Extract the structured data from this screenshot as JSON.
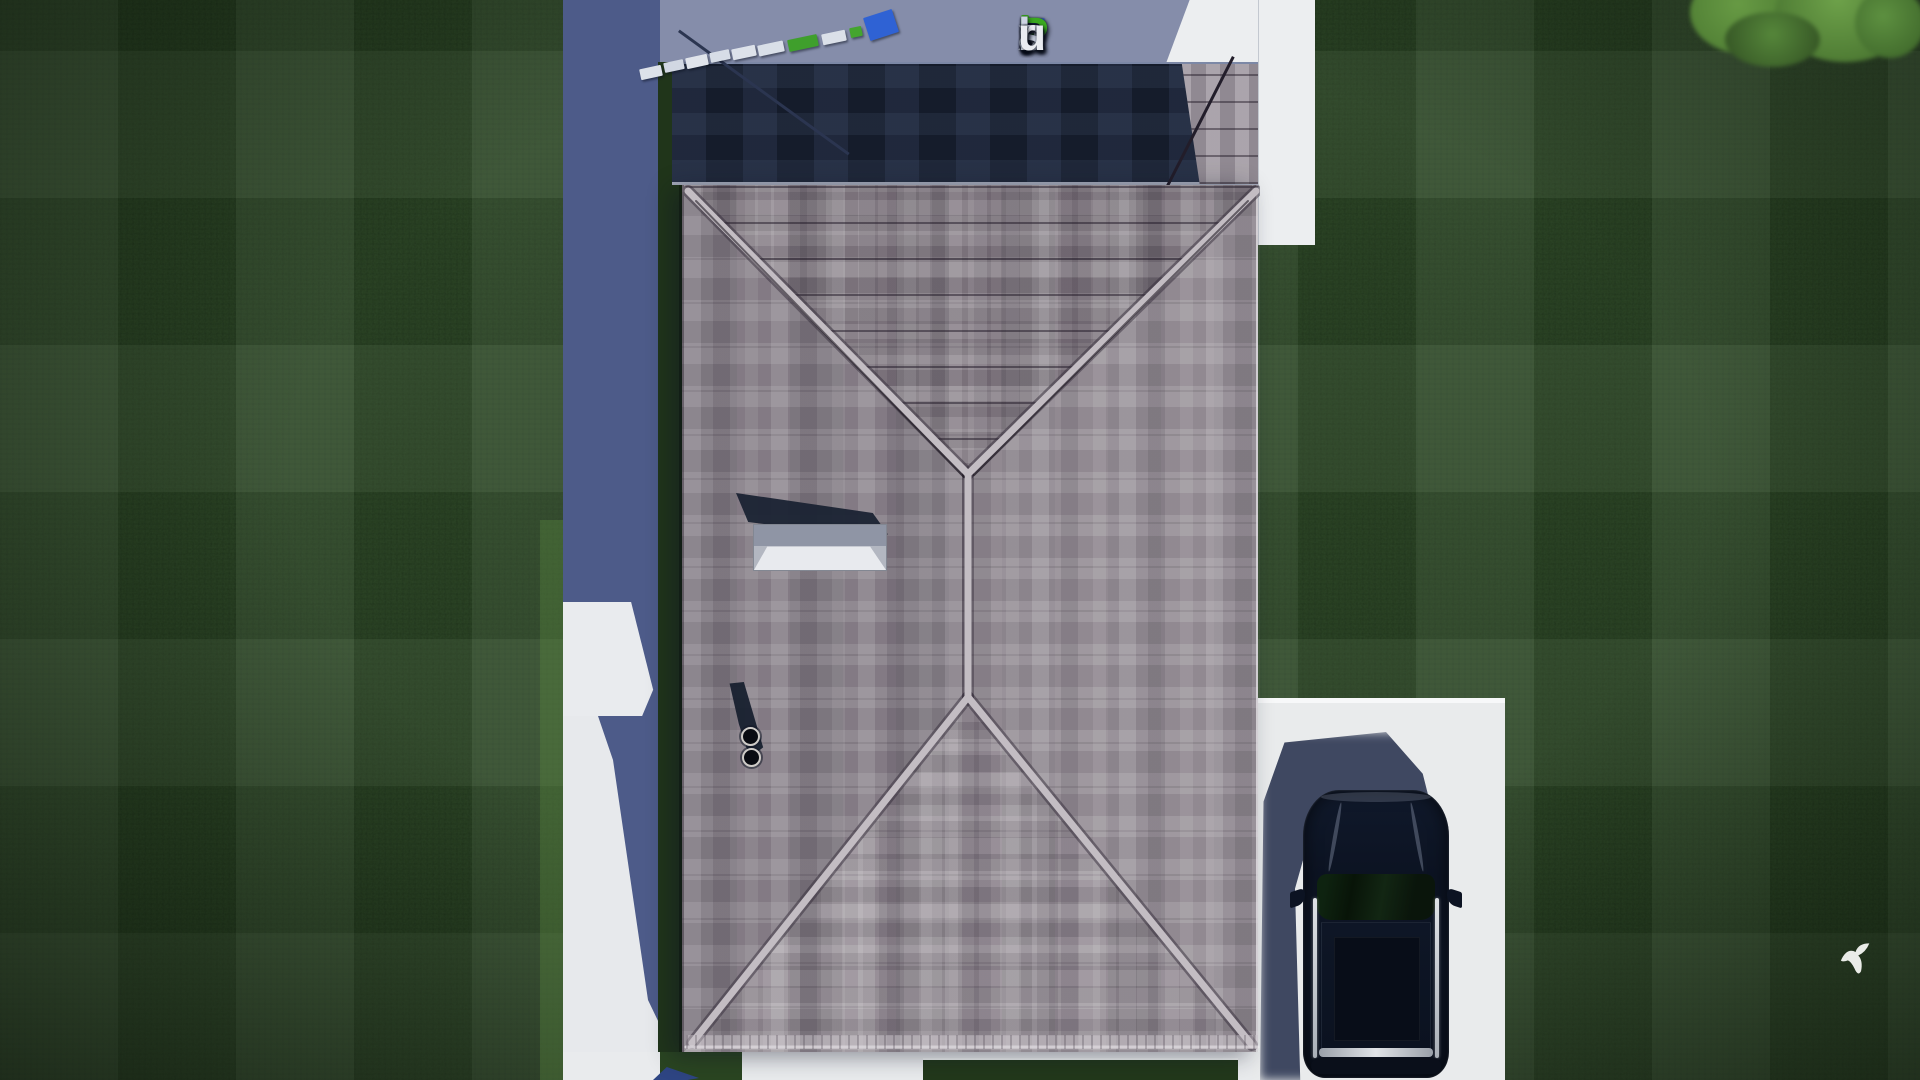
{
  "watermark": {
    "text": "FixPlans.ru",
    "letters": [
      {
        "ch": "F",
        "style": "color:#3156c8"
      },
      {
        "ch": "ı",
        "style": "color:#d6dbe7"
      },
      {
        "ch": "x",
        "style": "color:#c3cbdd"
      },
      {
        "ch": "P",
        "style": "color:#3aa81f"
      },
      {
        "ch": "l",
        "style": "color:#ccd3e2"
      },
      {
        "ch": "a",
        "style": "color:#ccd3e2"
      },
      {
        "ch": "n",
        "style": "color:#ccd3e2"
      },
      {
        "ch": "s",
        "style": "color:#c6cddd"
      },
      {
        "ch": ".",
        "style": "color:#2f7bd9"
      },
      {
        "ch": "r",
        "style": "color:#e9ebf1"
      },
      {
        "ch": "u",
        "style": "color:#e9ebf1"
      }
    ]
  },
  "palette": {
    "lawn_base": "#2a4423",
    "lawn_dark": "#1e3418",
    "concrete_white": "#eceef0",
    "concrete_shadow_deep": "#4d5b89",
    "concrete_shadow_light": "#858daa",
    "shingle_base": "#948c94",
    "shingle_light": "#aaa3aa",
    "shingle_dark": "#7b737d",
    "ridge_highlight": "#c3bdc3",
    "dark_roof_section": "#151c2b",
    "chimney_cap": "#e8eaee",
    "pipe_black": "#0a0c12",
    "car_body": "#0d1424",
    "car_shadow": "#2c3652",
    "logo_blue": "#3156c8",
    "logo_green": "#3aa81f",
    "logo_silver": "#ccd3e2",
    "bird_white": "#f2f4f0",
    "tree_green": "#5d9040"
  }
}
